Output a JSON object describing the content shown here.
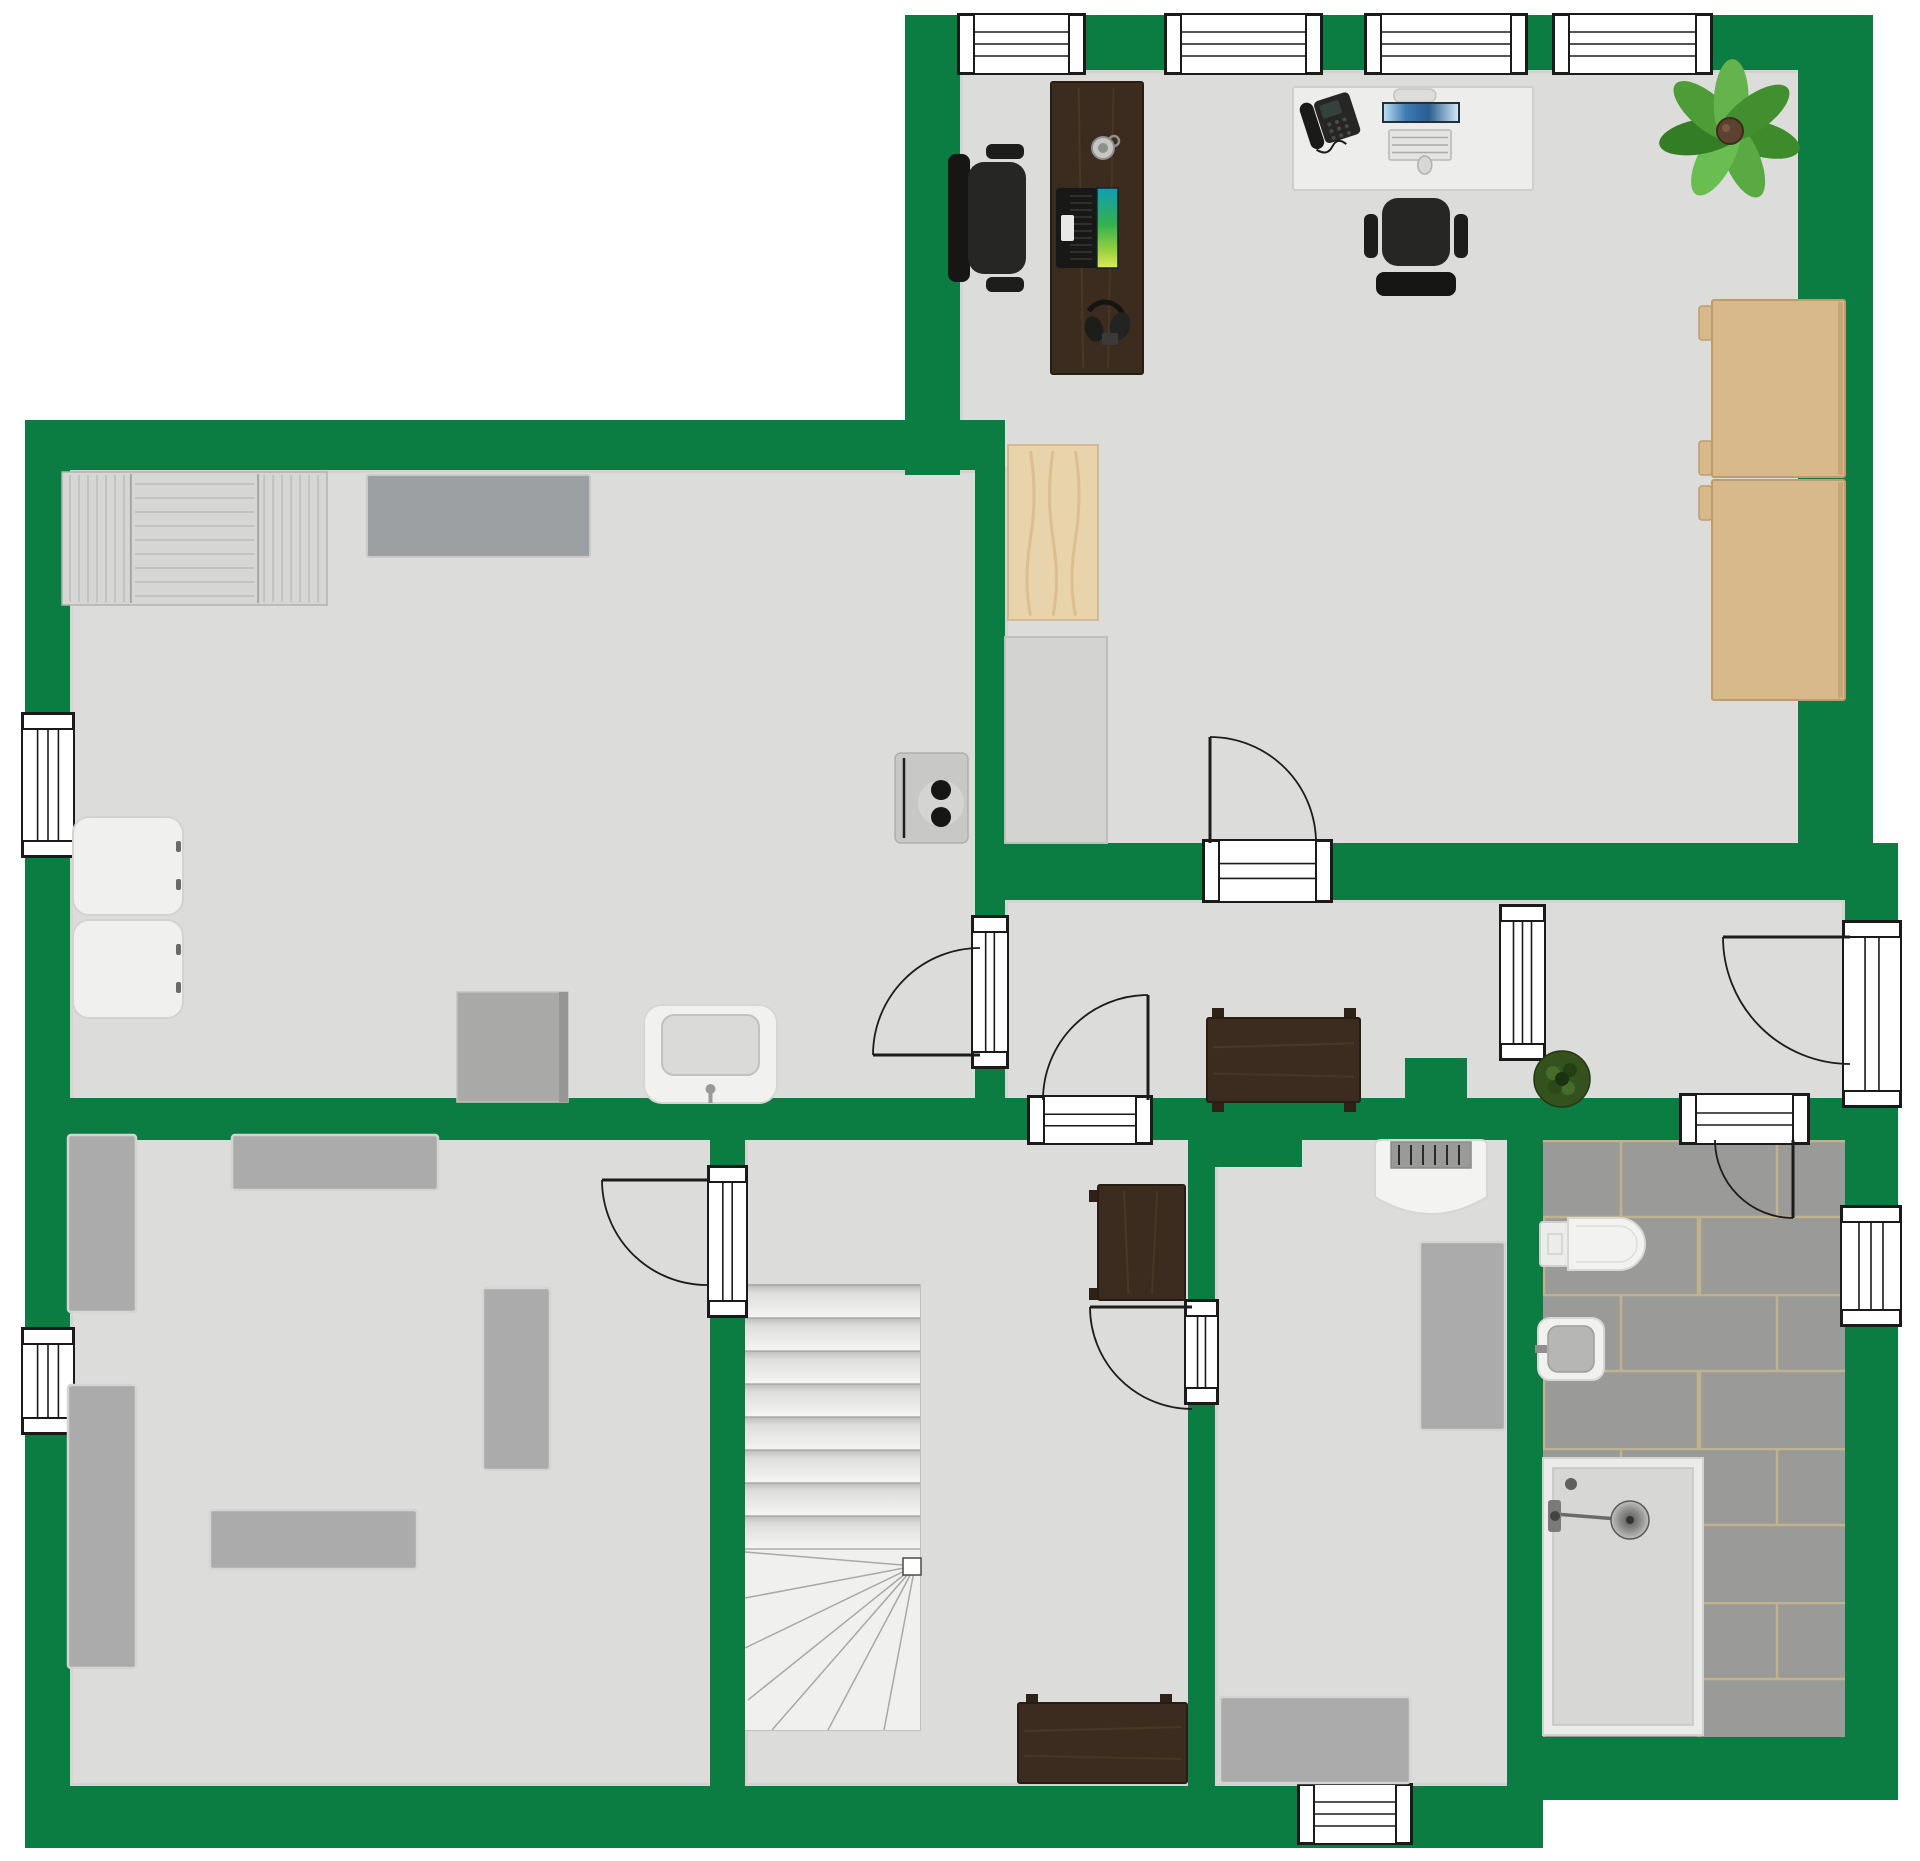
{
  "meta": {
    "width": 1920,
    "height": 1861,
    "kind": "floor-plan",
    "floors_text": "",
    "title": ""
  },
  "colors": {
    "wall": "#0b7c42",
    "floor": "#dcdcda",
    "floor_edge": "#c2c2c0",
    "outline": "#1a1a1a",
    "tile": "#9a9a98",
    "grout": "#c1b28e",
    "gray_furn": "#ababab",
    "gray_furn_stroke": "#d4d4d2",
    "dark_wood": "#3b2c1f",
    "dark_wood_edge": "#271d13",
    "dark_wood_streak": "#55402c",
    "tan": "#d8b98b",
    "tan_stroke": "#bd9c6d",
    "white_furn": "#f1f1ef",
    "white_furn_stroke": "#d6d6d4",
    "chair_dark": "#1f1f1f",
    "plant_center": "#5d4230",
    "plant_leaves": [
      "#3e8b2c",
      "#59aa43",
      "#6abd51",
      "#337d24",
      "#4d9c38",
      "#65b34c",
      "#428f30"
    ],
    "small_plant": "#33521d",
    "pot_brown": "#8a6a4a"
  },
  "floors": [
    {
      "name": "office-floor",
      "x": 960,
      "y": 70,
      "w": 885,
      "h": 830
    },
    {
      "name": "utility-room-floor",
      "x": 70,
      "y": 470,
      "w": 935,
      "h": 670
    },
    {
      "name": "hallway-floor",
      "x": 1005,
      "y": 900,
      "w": 840,
      "h": 240
    },
    {
      "name": "bedroom-floor",
      "x": 70,
      "y": 1135,
      "w": 675,
      "h": 651
    },
    {
      "name": "stair-room-floor",
      "x": 745,
      "y": 1135,
      "w": 470,
      "h": 651
    },
    {
      "name": "small-room-floor",
      "x": 1215,
      "y": 1135,
      "w": 328,
      "h": 651
    }
  ],
  "bathroom": {
    "name": "bathroom-floor",
    "x": 1543,
    "y": 1140,
    "w": 302,
    "h": 597,
    "tile_w": 156,
    "tile_h": 77
  },
  "walls": [
    {
      "name": "top-wall",
      "x": 905,
      "y": 15,
      "w": 968,
      "h": 55
    },
    {
      "name": "office-left-wall",
      "x": 905,
      "y": 15,
      "w": 55,
      "h": 460
    },
    {
      "name": "office-right-wall",
      "x": 1798,
      "y": 15,
      "w": 75,
      "h": 885
    },
    {
      "name": "hallway-top-wall",
      "x": 1005,
      "y": 843,
      "w": 893,
      "h": 57
    },
    {
      "name": "utility-top-wall",
      "x": 25,
      "y": 420,
      "w": 980,
      "h": 50
    },
    {
      "name": "left-wall",
      "x": 25,
      "y": 420,
      "w": 45,
      "h": 1428
    },
    {
      "name": "utility-hall-divider",
      "x": 975,
      "y": 470,
      "w": 30,
      "h": 668
    },
    {
      "name": "section-wall",
      "x": 25,
      "y": 1098,
      "w": 1873,
      "h": 42
    },
    {
      "name": "bedroom-divider-wall",
      "x": 710,
      "y": 1135,
      "w": 35,
      "h": 651
    },
    {
      "name": "stair-divider-wall",
      "x": 1188,
      "y": 1135,
      "w": 27,
      "h": 651
    },
    {
      "name": "wall-jog",
      "x": 1215,
      "y": 1140,
      "w": 87,
      "h": 27
    },
    {
      "name": "bathroom-divider-wall",
      "x": 1507,
      "y": 1135,
      "w": 36,
      "h": 651
    },
    {
      "name": "right-wall",
      "x": 1845,
      "y": 843,
      "w": 53,
      "h": 957
    },
    {
      "name": "bottom-wall",
      "x": 25,
      "y": 1786,
      "w": 1518,
      "h": 62
    },
    {
      "name": "bathroom-bottom-wall",
      "x": 1510,
      "y": 1737,
      "w": 388,
      "h": 63
    },
    {
      "name": "hall-stub-wall",
      "x": 1405,
      "y": 1058,
      "w": 62,
      "h": 82
    }
  ],
  "openings": [
    {
      "name": "window-top-1",
      "x": 958,
      "y": 14,
      "w": 127,
      "h": 60,
      "orient": "h",
      "style": "window"
    },
    {
      "name": "window-top-2",
      "x": 1165,
      "y": 14,
      "w": 157,
      "h": 60,
      "orient": "h",
      "style": "window"
    },
    {
      "name": "window-top-3",
      "x": 1365,
      "y": 14,
      "w": 162,
      "h": 60,
      "orient": "h",
      "style": "window"
    },
    {
      "name": "window-top-4",
      "x": 1553,
      "y": 14,
      "w": 159,
      "h": 60,
      "orient": "h",
      "style": "window"
    },
    {
      "name": "window-left-upper",
      "x": 22,
      "y": 713,
      "w": 52,
      "h": 144,
      "orient": "v",
      "style": "window"
    },
    {
      "name": "window-left-bedroom",
      "x": 22,
      "y": 1328,
      "w": 52,
      "h": 106,
      "orient": "v",
      "style": "window"
    },
    {
      "name": "window-bathroom",
      "x": 1841,
      "y": 1206,
      "w": 60,
      "h": 120,
      "orient": "v",
      "style": "window"
    },
    {
      "name": "window-bottom",
      "x": 1298,
      "y": 1784,
      "w": 114,
      "h": 60,
      "orient": "h",
      "style": "window"
    },
    {
      "name": "hall-partition-window",
      "x": 1500,
      "y": 905,
      "w": 45,
      "h": 155,
      "orient": "v",
      "style": "window"
    },
    {
      "name": "office-door-threshold",
      "x": 1203,
      "y": 840,
      "w": 129,
      "h": 62,
      "orient": "h",
      "style": "door"
    },
    {
      "name": "utility-door-threshold",
      "x": 972,
      "y": 916,
      "w": 36,
      "h": 152,
      "orient": "v",
      "style": "door"
    },
    {
      "name": "stair-room-door-threshold",
      "x": 1028,
      "y": 1096,
      "w": 124,
      "h": 48,
      "orient": "h",
      "style": "door"
    },
    {
      "name": "bedroom-door-threshold",
      "x": 708,
      "y": 1166,
      "w": 39,
      "h": 151,
      "orient": "v",
      "style": "door"
    },
    {
      "name": "small-room-door-threshold",
      "x": 1185,
      "y": 1300,
      "w": 33,
      "h": 104,
      "orient": "v",
      "style": "door"
    },
    {
      "name": "bathroom-door-threshold",
      "x": 1680,
      "y": 1094,
      "w": 129,
      "h": 50,
      "orient": "h",
      "style": "door"
    },
    {
      "name": "front-door-threshold",
      "x": 1843,
      "y": 921,
      "w": 58,
      "h": 186,
      "orient": "v",
      "style": "door"
    }
  ],
  "door_swings": [
    {
      "name": "office-door-swing",
      "panel": [
        1210,
        843,
        1210,
        737
      ],
      "from": [
        1210,
        737
      ],
      "to": [
        1316,
        843
      ],
      "r": 106,
      "sweep": 1
    },
    {
      "name": "utility-door-swing",
      "panel": [
        980,
        1055,
        873,
        1055
      ],
      "from": [
        873,
        1055
      ],
      "to": [
        980,
        948
      ],
      "r": 107,
      "sweep": 1
    },
    {
      "name": "stair-room-door-swing",
      "panel": [
        1148,
        1100,
        1148,
        995
      ],
      "from": [
        1148,
        995
      ],
      "to": [
        1043,
        1100
      ],
      "r": 105,
      "sweep": 0
    },
    {
      "name": "bedroom-door-swing",
      "panel": [
        707,
        1180,
        602,
        1180
      ],
      "from": [
        602,
        1180
      ],
      "to": [
        707,
        1285
      ],
      "r": 105,
      "sweep": 0
    },
    {
      "name": "small-room-door-swing",
      "panel": [
        1192,
        1307,
        1090,
        1307
      ],
      "from": [
        1090,
        1307
      ],
      "to": [
        1192,
        1409
      ],
      "r": 102,
      "sweep": 0
    },
    {
      "name": "bathroom-door-swing",
      "panel": [
        1793,
        1140,
        1793,
        1218
      ],
      "from": [
        1793,
        1218
      ],
      "to": [
        1715,
        1140
      ],
      "r": 78,
      "sweep": 1
    },
    {
      "name": "front-door-swing",
      "panel": [
        1850,
        937,
        1723,
        937
      ],
      "from": [
        1723,
        937
      ],
      "to": [
        1850,
        1064
      ],
      "r": 127,
      "sweep": 0
    }
  ],
  "stairs": {
    "name": "staircase",
    "x": 745,
    "y": 1285,
    "w": 175,
    "straight_end": 1549,
    "tread": 33,
    "bottom": 1730,
    "pivot": [
      915,
      1566
    ],
    "fan": [
      [
        745,
        1552
      ],
      [
        745,
        1598
      ],
      [
        745,
        1648
      ],
      [
        748,
        1700
      ],
      [
        772,
        1730
      ],
      [
        828,
        1730
      ],
      [
        884,
        1730
      ]
    ],
    "newel": [
      903,
      1558,
      18,
      17
    ]
  },
  "furniture": [
    {
      "name": "office-desk",
      "kind": "wood_desk",
      "x": 1051,
      "y": 82,
      "w": 92,
      "h": 292
    },
    {
      "name": "office-chair-left",
      "kind": "chair",
      "x": 948,
      "y": 138,
      "w": 100,
      "h": 160,
      "facing": "right"
    },
    {
      "name": "laptop",
      "kind": "laptop",
      "x": 1056,
      "y": 188,
      "w": 62,
      "h": 80
    },
    {
      "name": "mug",
      "kind": "mug",
      "cx": 1103,
      "cy": 148,
      "r": 11
    },
    {
      "name": "headset",
      "kind": "headset",
      "cx": 1106,
      "cy": 319
    },
    {
      "name": "white-desk",
      "kind": "white_desk",
      "x": 1293,
      "y": 87,
      "w": 240,
      "h": 103
    },
    {
      "name": "desk-phone",
      "kind": "phone",
      "x": 1304,
      "y": 96,
      "w": 52,
      "h": 48
    },
    {
      "name": "workstation",
      "kind": "monitor",
      "x": 1383,
      "y": 103,
      "w": 76,
      "h": 66
    },
    {
      "name": "office-chair-top",
      "kind": "chair",
      "x": 1362,
      "y": 188,
      "w": 108,
      "h": 108,
      "facing": "up"
    },
    {
      "name": "office-plant",
      "kind": "plant",
      "cx": 1730,
      "cy": 131,
      "r": 58
    },
    {
      "name": "wardrobe-upper",
      "kind": "tan_cabinet",
      "x": 1712,
      "y": 300,
      "w": 133,
      "h": 177,
      "tabs": [
        [
          1701,
          306
        ],
        [
          1701,
          441
        ]
      ]
    },
    {
      "name": "wardrobe-lower",
      "kind": "tan_cabinet",
      "x": 1712,
      "y": 480,
      "w": 133,
      "h": 220,
      "tabs": [
        [
          1701,
          486
        ]
      ]
    },
    {
      "name": "wood-board",
      "kind": "plank",
      "x": 1008,
      "y": 445,
      "w": 90,
      "h": 175
    },
    {
      "name": "counter",
      "kind": "counter",
      "x": 1005,
      "y": 637,
      "w": 102,
      "h": 206
    },
    {
      "name": "boiler",
      "kind": "boiler",
      "x": 895,
      "y": 753,
      "w": 73,
      "h": 90
    },
    {
      "name": "drying-rack",
      "kind": "rack",
      "x": 62,
      "y": 472,
      "w": 265,
      "h": 133
    },
    {
      "name": "sideboard",
      "kind": "sideboard",
      "x": 367,
      "y": 475,
      "w": 223,
      "h": 82
    },
    {
      "name": "washer-upper",
      "kind": "washer",
      "x": 73,
      "y": 817,
      "w": 110,
      "h": 98
    },
    {
      "name": "washer-lower",
      "kind": "washer",
      "x": 73,
      "y": 920,
      "w": 110,
      "h": 98
    },
    {
      "name": "small-cabinet",
      "kind": "cabinet",
      "x": 457,
      "y": 992,
      "w": 111,
      "h": 110
    },
    {
      "name": "utility-sink",
      "kind": "sink_unit",
      "x": 644,
      "y": 1005,
      "w": 133,
      "h": 98
    },
    {
      "name": "console-table",
      "kind": "console",
      "x": 1207,
      "y": 1018,
      "w": 153,
      "h": 84,
      "feet": [
        [
          1212,
          1008,
          12,
          10
        ],
        [
          1344,
          1008,
          12,
          10
        ],
        [
          1212,
          1102,
          12,
          10
        ],
        [
          1344,
          1102,
          12,
          10
        ]
      ]
    },
    {
      "name": "hall-plant",
      "kind": "plant_small",
      "cx": 1562,
      "cy": 1079,
      "r": 28
    },
    {
      "name": "bedroom-cabinet-1",
      "kind": "gray_rect",
      "x": 68,
      "y": 1135,
      "w": 68,
      "h": 177
    },
    {
      "name": "bedroom-cabinet-2",
      "kind": "gray_rect",
      "x": 232,
      "y": 1135,
      "w": 206,
      "h": 55
    },
    {
      "name": "bedroom-cabinet-3",
      "kind": "gray_rect",
      "x": 68,
      "y": 1385,
      "w": 68,
      "h": 283
    },
    {
      "name": "bedroom-cabinet-4",
      "kind": "gray_rect",
      "x": 483,
      "y": 1288,
      "w": 67,
      "h": 182
    },
    {
      "name": "bedroom-cabinet-5",
      "kind": "gray_rect",
      "x": 210,
      "y": 1510,
      "w": 207,
      "h": 59
    },
    {
      "name": "stair-desk-upper",
      "kind": "dark_desk",
      "x": 1098,
      "y": 1185,
      "w": 87,
      "h": 115,
      "feet": [
        [
          1089,
          1190,
          9,
          12
        ],
        [
          1089,
          1288,
          9,
          12
        ]
      ]
    },
    {
      "name": "stair-desk-lower",
      "kind": "dark_desk",
      "x": 1018,
      "y": 1703,
      "w": 169,
      "h": 80,
      "feet": [
        [
          1026,
          1694,
          12,
          9
        ],
        [
          1160,
          1694,
          12,
          9
        ]
      ]
    },
    {
      "name": "open-wardrobe",
      "kind": "open_wardrobe",
      "x": 1375,
      "y": 1140,
      "w": 112,
      "h": 75
    },
    {
      "name": "small-room-cabinet-1",
      "kind": "gray_rect",
      "x": 1420,
      "y": 1242,
      "w": 85,
      "h": 188
    },
    {
      "name": "small-room-cabinet-2",
      "kind": "gray_rect",
      "x": 1220,
      "y": 1697,
      "w": 190,
      "h": 86
    },
    {
      "name": "toilet",
      "kind": "toilet",
      "x": 1540,
      "y": 1218,
      "w": 105,
      "h": 52
    },
    {
      "name": "bath-sink",
      "kind": "sink_small",
      "x": 1538,
      "y": 1318,
      "w": 66,
      "h": 62
    },
    {
      "name": "shower",
      "kind": "shower",
      "x": 1543,
      "y": 1458,
      "w": 160,
      "h": 277
    }
  ]
}
